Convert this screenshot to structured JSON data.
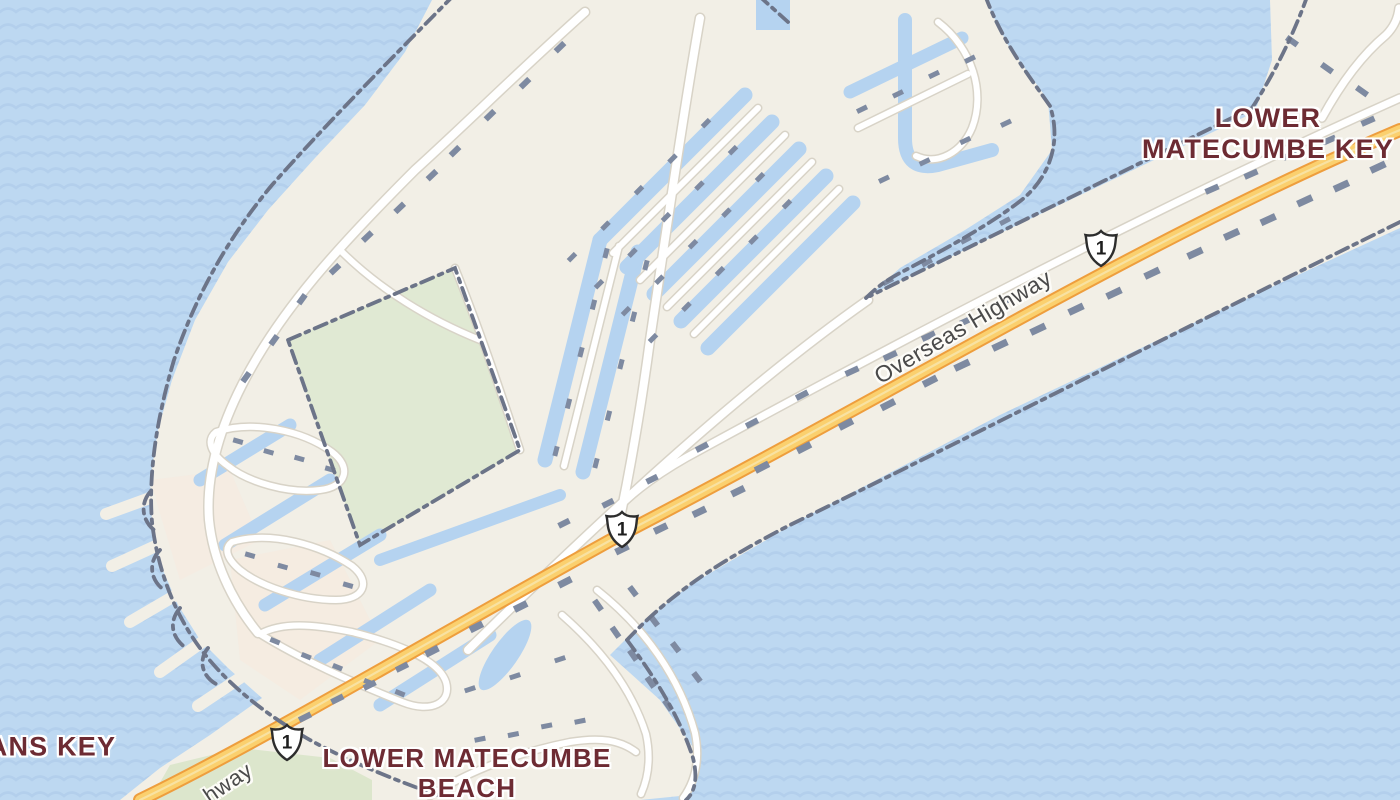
{
  "map": {
    "type": "road-map-view",
    "place_labels": {
      "key_name": {
        "line1": "LOWER",
        "line2": "MATECUMBE KEY"
      },
      "beach_name": {
        "line1": "LOWER MATECUMBE",
        "line2": "BEACH"
      },
      "left_edge_partial": "ANS KEY"
    },
    "road_labels": {
      "overseas_highway": "Overseas Highway",
      "overseas_highway_partial": "hway"
    },
    "route_shields": [
      {
        "icon": "us-route-shield-icon",
        "number": "1"
      },
      {
        "icon": "us-route-shield-icon",
        "number": "1"
      },
      {
        "icon": "us-route-shield-icon",
        "number": "1"
      }
    ],
    "colors": {
      "water": "#bdd8f1",
      "wave_pattern": "#afccea",
      "land": "#f2efe6",
      "park_green": "#e0e9d3",
      "canal": "#b5d3f0",
      "road_fill": "#ffffff",
      "road_casing": "#d8d3c7",
      "highway_fill": "#fbd06e",
      "highway_casing": "#ee9e3d",
      "building": "#7e8aa1",
      "boundary_line": "#6c7488",
      "place_label": "#6d2b33",
      "road_label": "#4a4a4a"
    }
  }
}
